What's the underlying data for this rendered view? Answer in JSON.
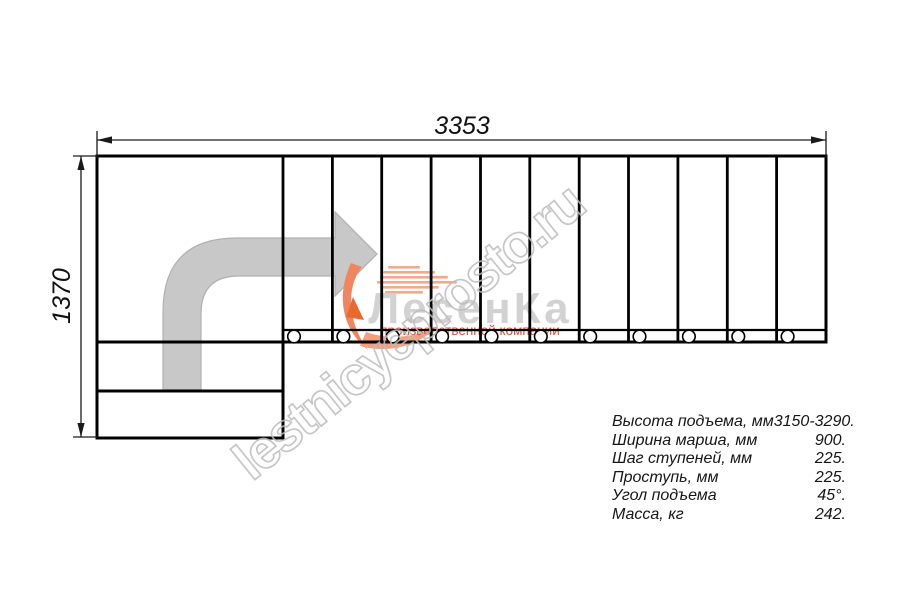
{
  "dimensions": {
    "width_mm": "3353",
    "height_mm": "1370"
  },
  "plan": {
    "tread_count": 11,
    "baluster_count": 11
  },
  "specs": {
    "rows": [
      {
        "label": "Высота подъема, мм",
        "value": "3150-3290."
      },
      {
        "label": "Ширина марша, мм",
        "value": "900."
      },
      {
        "label": "Шаг ступеней, мм",
        "value": "225."
      },
      {
        "label": "Проступь, мм",
        "value": "225."
      },
      {
        "label": "Угол подъема",
        "value": "45°."
      },
      {
        "label": "Масса, кг",
        "value": "242."
      }
    ]
  },
  "logo": {
    "name": "ЛесенКа",
    "tagline": "производственной компании"
  },
  "watermark": {
    "text": "lestnicyeprosto.ru"
  },
  "colors": {
    "line": "#000000",
    "dimension": "#1a1a1a",
    "arrow_fill": "#c8c8c8",
    "logo_orange": "#ef8660",
    "logo_gray": "#d2d2d2",
    "tagline_red": "#dd4f3c",
    "watermark_gray": "#bdbdbd"
  }
}
